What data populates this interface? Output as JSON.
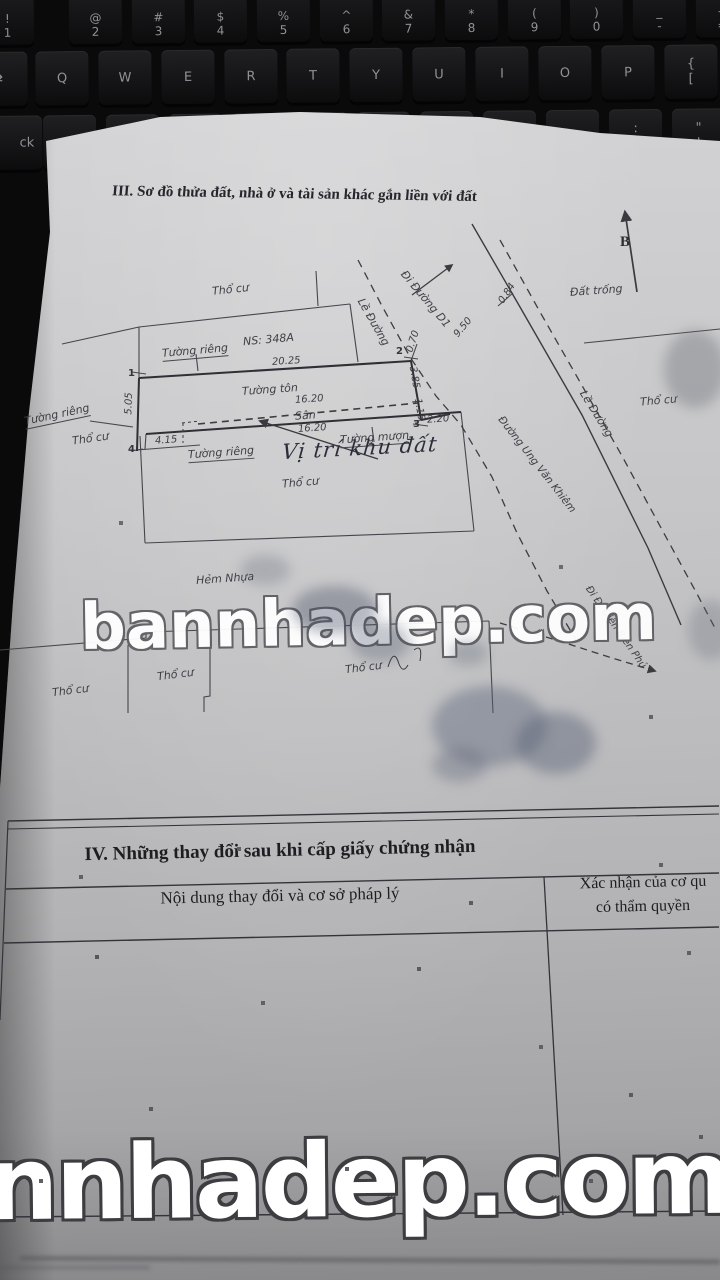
{
  "keyboard": {
    "num_row": [
      "!\n1",
      "@\n2",
      "#\n3",
      "$\n4",
      "%\n5",
      "^\n6",
      "&\n7",
      "*\n8",
      "(\n9",
      ")\n0",
      "_\n-",
      "+\n="
    ],
    "qwerty_row": [
      "Q",
      "W",
      "E",
      "R",
      "T",
      "Y",
      "U",
      "I",
      "O",
      "P",
      "{\n["
    ],
    "home_row": [
      "A",
      "S",
      "D",
      "F",
      "G",
      "H",
      "J",
      "K",
      "L",
      ":\n;",
      "\"\n'"
    ],
    "tab_fragment": "⇄",
    "caps_fragment": "ck"
  },
  "document": {
    "section3_title": "III. Sơ đồ thửa đất, nhà ở và tài sản khác gắn liền với đất",
    "north_label": "B",
    "diagram": {
      "labels": {
        "tho_cu": "Thổ cư",
        "ns_block": "NS: 348A",
        "tuong_rieng": "Tường riêng",
        "tuong_ton": "Tường tôn",
        "san": "Sân",
        "tuong_muon": "Tường mượn",
        "vi_tri_khu_dat": "Vị trí khu đất",
        "hem_nhua": "Hẻm Nhựa",
        "dat_trong": "Đất trống",
        "le_duong": "Lề Đường",
        "di_duong_d1": "Đi Đường D1",
        "duong_ung_van_khiem": "Đường Ung Văn Khiêm",
        "di_dien_bien_phu": "Đi Đ. Điện Biên Phủ"
      },
      "dimensions": {
        "top": "20.25",
        "mid": "16.20",
        "bottom_mid": "16.20",
        "left": "5.05",
        "bottom_left": "4.15",
        "corner2": "0.70",
        "right_upper": "3.85",
        "right_jog": "1.15",
        "corner3": "2.20",
        "road": "9.50",
        "road_tick": "0.84"
      },
      "points": [
        "1",
        "2",
        "3",
        "4"
      ]
    },
    "section4": {
      "title": "IV. Những thay đổi sau khi cấp giấy chứng nhận",
      "col1_header": "Nội dung thay đổi và cơ sở pháp lý",
      "col2_header_line1": "Xác nhận của cơ qu",
      "col2_header_line2": "có thẩm quyền"
    },
    "watermark_mid": "bannhadep.com",
    "watermark_bottom": "nnhadep.com"
  },
  "colors": {
    "paper": "#c6c6c8",
    "ink": "#3e3e45",
    "keyboard_key": "#151517",
    "watermark_fill": "#ffffff"
  }
}
